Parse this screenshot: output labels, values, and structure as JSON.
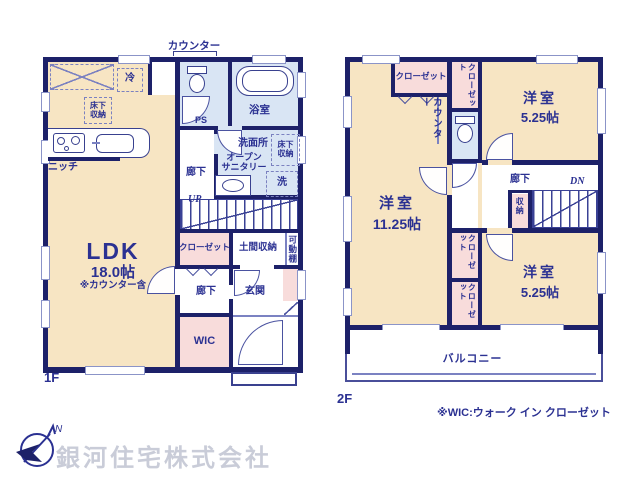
{
  "palette": {
    "wall": "#1d2169",
    "text": "#2b3192",
    "room": "#f7e5c3",
    "wet": "#d9e5f4",
    "closet": "#f8dcdb",
    "company_gray": "#c9ccd8"
  },
  "floor1": {
    "name": "1F",
    "labels": {
      "counter": "カウンター",
      "fridge": "冷",
      "underfloor_kitchen": "床下\n収納",
      "niche": "ニッチ",
      "bath": "浴室",
      "ps": "PS",
      "washroom": "洗面所",
      "open_sanitary": "オープン\nサニタリー",
      "underfloor_wash": "床下\n収納",
      "washer": "洗",
      "hall_upper": "廊下",
      "up": "UP",
      "ldk": "LDK",
      "ldk_size": "18.0帖",
      "ldk_note": "※カウンター含",
      "closet": "クローゼット",
      "doma": "土間収納",
      "shelf": "可動棚",
      "hall_lower": "廊下",
      "entrance": "玄関",
      "wic": "WIC"
    }
  },
  "floor2": {
    "name": "2F",
    "labels": {
      "closet_nw": "クローゼット",
      "closet_col_top": "クローゼット",
      "counter": "カウンター",
      "room_ne": "洋室",
      "room_ne_size": "5.25帖",
      "hall": "廊下",
      "dn": "DN",
      "storage": "収納",
      "room_w": "洋室",
      "room_w_size": "11.25帖",
      "closet_col_mid": "クローゼット",
      "closet_col_bottom": "クローゼット",
      "room_se": "洋室",
      "room_se_size": "5.25帖",
      "balcony": "バルコニー"
    }
  },
  "footer": {
    "wic_note": "※WIC:ウォーク イン クローゼット",
    "company": "銀河住宅株式会社",
    "compass_north": "N"
  }
}
